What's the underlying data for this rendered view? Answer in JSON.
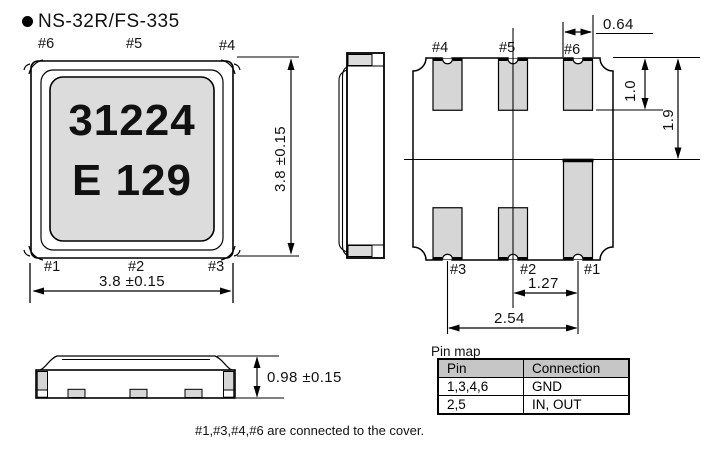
{
  "title": "NS-32R/FS-335",
  "top_view": {
    "pin_top": [
      "#6",
      "#5",
      "#4"
    ],
    "pin_bottom": [
      "#1",
      "#2",
      "#3"
    ],
    "marking_line1": "31224",
    "marking_line2": "E 129",
    "dim_width": "3.8 ±0.15",
    "dim_height": "3.8 ±0.15"
  },
  "bottom_view": {
    "pin_top": [
      "#4",
      "#5",
      "#6"
    ],
    "pin_bottom": [
      "#3",
      "#2",
      "#1"
    ],
    "dim_pad_width": "0.64",
    "dim_pad_length": "1.0",
    "dim_corner_pad_length": "1.9",
    "dim_pitch": "1.27",
    "dim_span": "2.54"
  },
  "front_view": {
    "dim_height": "0.98 ±0.15"
  },
  "pin_map": {
    "title": "Pin map",
    "headers": [
      "Pin",
      "Connection"
    ],
    "rows": [
      {
        "pin": "1,3,4,6",
        "connection": "GND"
      },
      {
        "pin": "2,5",
        "connection": "IN, OUT"
      }
    ]
  },
  "note": "#1,#3,#4,#6 are connected to the cover.",
  "colors": {
    "line": "#000000",
    "pad_fill": "#d6d6d6",
    "marking_fill": "#dcdcdc",
    "table_header_bg": "#c6c6c6"
  }
}
